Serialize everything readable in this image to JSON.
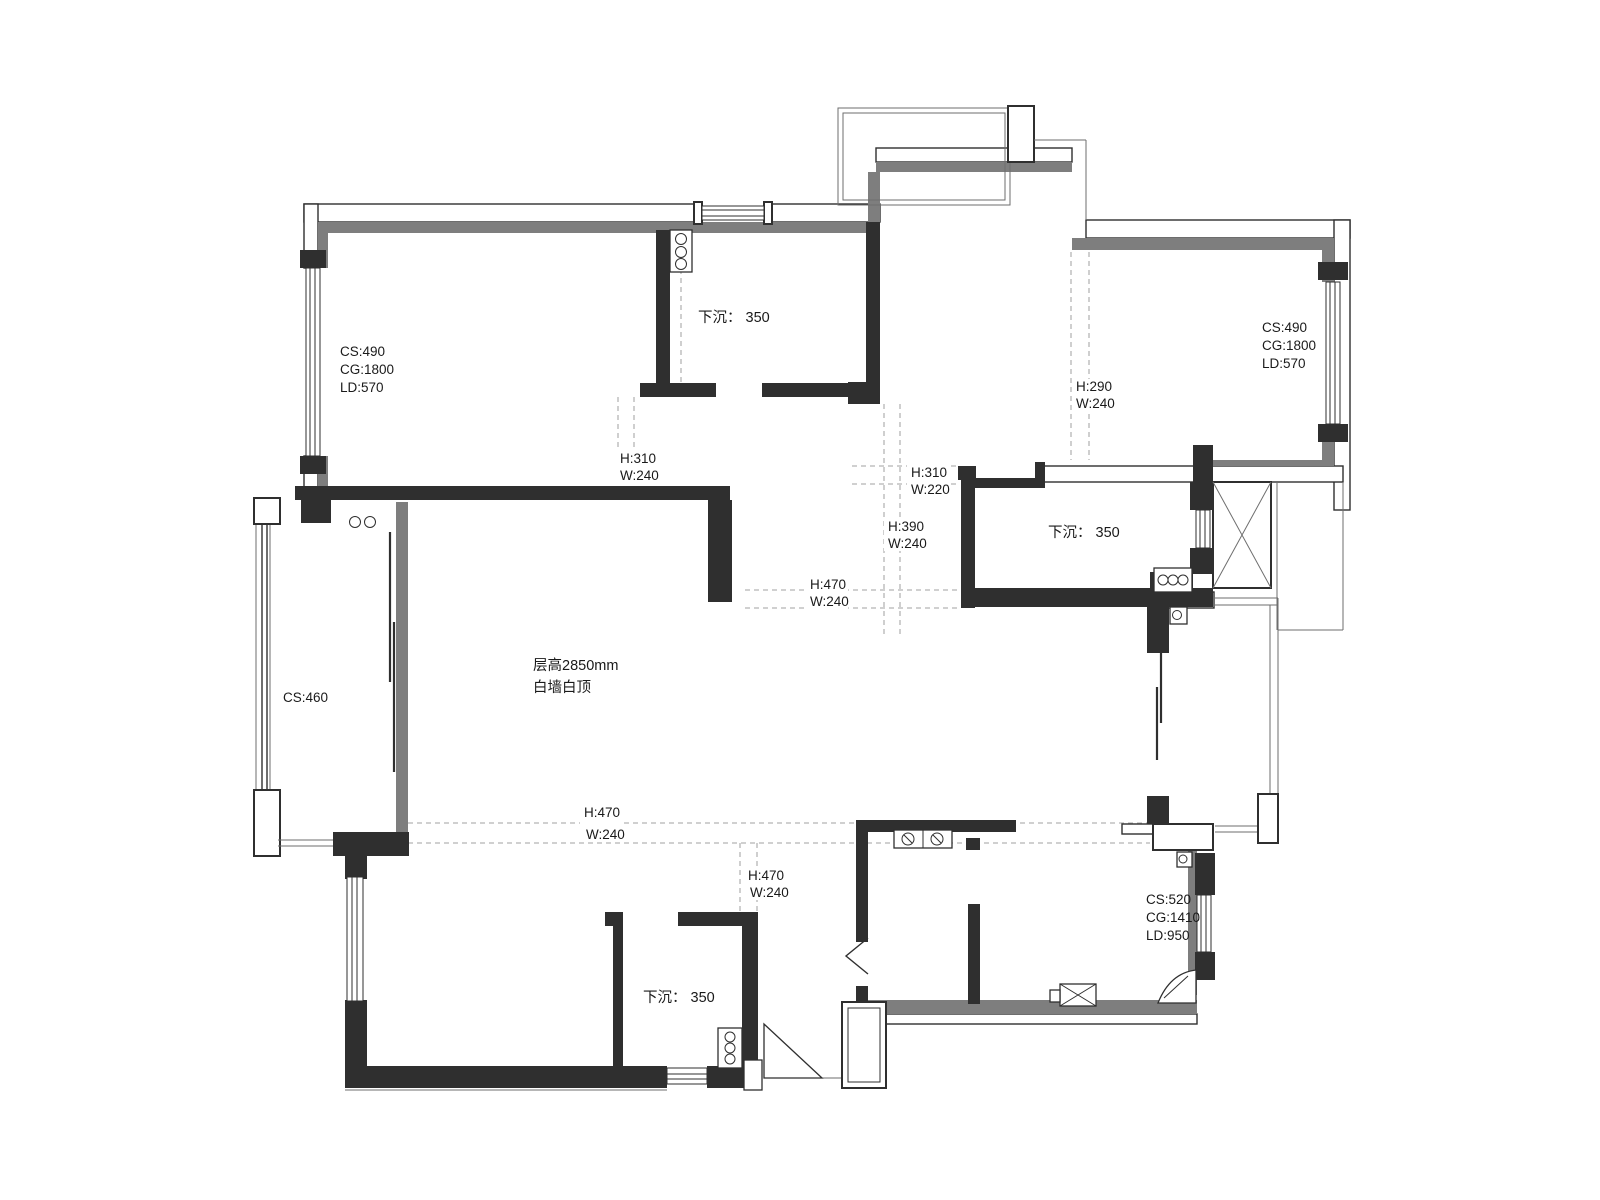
{
  "title": "residential floor plan",
  "colors": {
    "wall": "#2f2f2f",
    "insulation": "#7e7e7e",
    "dash_line": "#b5b5b5",
    "text": "#1a1a1a",
    "background": "#ffffff"
  },
  "plan": {
    "ceiling_note": {
      "line1": "层高2850mm",
      "line2": "白墙白顶"
    },
    "sunken_areas": [
      {
        "label": "下沉： 350"
      },
      {
        "label": "下沉： 350"
      },
      {
        "label": "下沉： 350"
      }
    ],
    "windows": {
      "top_left": {
        "cs": "CS:490",
        "cg": "CG:1800",
        "ld": "LD:570"
      },
      "top_right": {
        "cs": "CS:490",
        "cg": "CG:1800",
        "ld": "LD:570"
      },
      "bottom_right": {
        "cs": "CS:520",
        "cg": "CG:1410",
        "ld": "LD:950"
      },
      "left_balcony": {
        "cs": "CS:460"
      }
    },
    "beams": {
      "b1": {
        "h": "H:310",
        "w": "W:240"
      },
      "b2": {
        "h": "H:290",
        "w": "W:240"
      },
      "b3": {
        "h": "H:310",
        "w": "W:220"
      },
      "b4": {
        "h": "H:390",
        "w": "W:240"
      },
      "b5": {
        "h": "H:470",
        "w": "W:240"
      },
      "b6": {
        "h": "H:470",
        "w": "W:240"
      },
      "b7": {
        "h": "H:470",
        "w": "W:240"
      }
    }
  }
}
